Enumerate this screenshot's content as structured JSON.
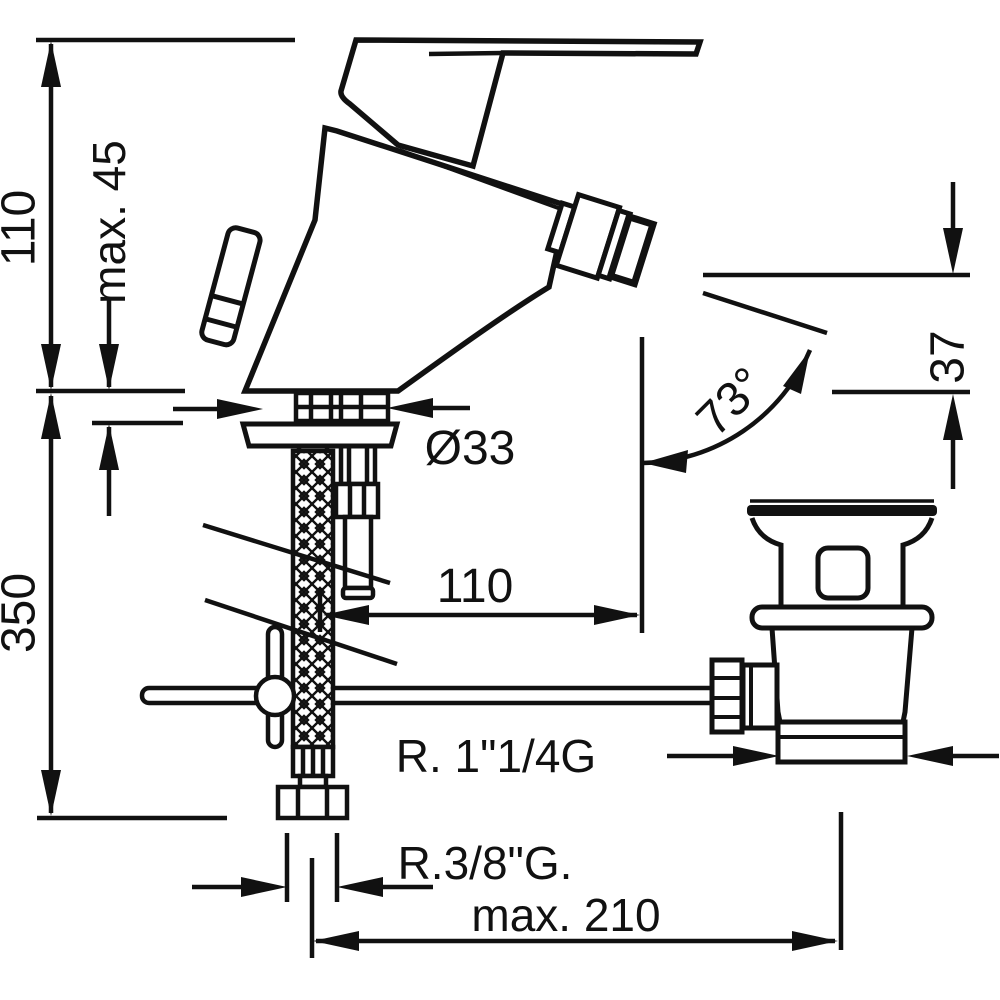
{
  "drawing": {
    "title": "bidet-mixer-installation-drawing",
    "background": "#ffffff",
    "line_color": "#111111",
    "dimensions": {
      "total_height": "110",
      "max_deck_thickness": "max. 45",
      "below_deck_depth": "350",
      "mounting_hole_diameter": "Ø33",
      "spout_projection": "110",
      "outlet_height": "37",
      "outlet_angle": "73°",
      "waste_thread": "R. 1\"1/4G",
      "supply_thread": "R.3/8\"G.",
      "max_rod_length": "max. 210"
    }
  }
}
